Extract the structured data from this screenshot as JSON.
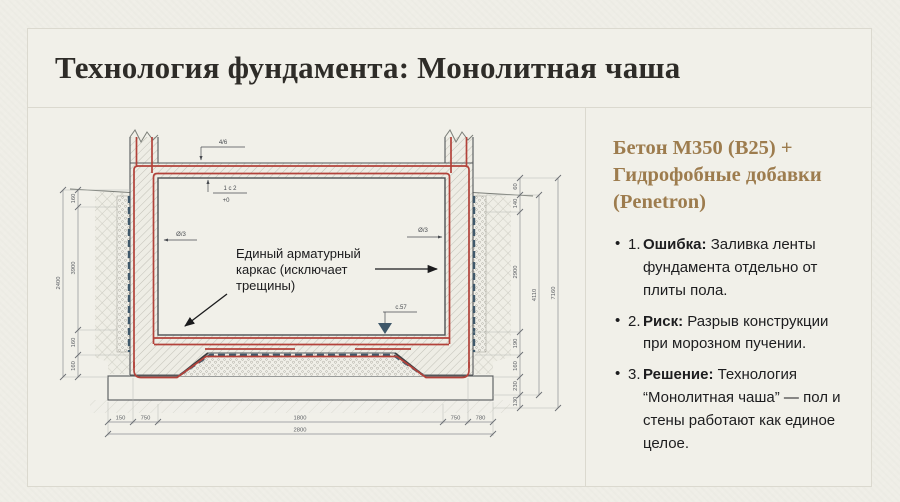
{
  "slide": {
    "title": "Технология фундамента: Монолитная чаша"
  },
  "right_panel": {
    "heading_lines": [
      "Бетон М350 (В25) +",
      "Гидрофобные добавки",
      "(Penetron)"
    ],
    "heading_color": "#9d7c4e",
    "bullet_marker": "•",
    "bullets": [
      {
        "number": "1.",
        "lead": "Ошибка:",
        "text": "Заливка ленты фундамента отдельно от плиты пола."
      },
      {
        "number": "2.",
        "lead": "Риск:",
        "text": "Разрыв конструкции при морозном пучении."
      },
      {
        "number": "3.",
        "lead": "Решение:",
        "text": "Технология “Монолитная чаша” — пол и стены работают как единое целое."
      }
    ]
  },
  "drawing": {
    "annotation_lines": [
      "Единый арматурный",
      "каркас (исключает",
      "трещины)"
    ],
    "marks": {
      "top": "4/6",
      "level_top": "1 с 2",
      "level_zero": "+0",
      "wall_left": "Ø/3",
      "wall_right": "Ø/3",
      "floor": "с.57"
    },
    "dims": {
      "bottom": [
        "150",
        "750",
        "1800",
        "750",
        "780"
      ],
      "bottom_total": "2800",
      "left": [
        "160",
        "3900",
        "160",
        "160"
      ],
      "left_total": "2400",
      "right": [
        "60",
        "140",
        "2900",
        "190",
        "160",
        "230",
        "130"
      ],
      "right_mid_total": "4110",
      "right_total": "7160"
    },
    "colors": {
      "rebar": "#b2423a",
      "membrane": "#3f586a",
      "hatch": "#b6b5ab",
      "outline": "#54575a"
    }
  }
}
